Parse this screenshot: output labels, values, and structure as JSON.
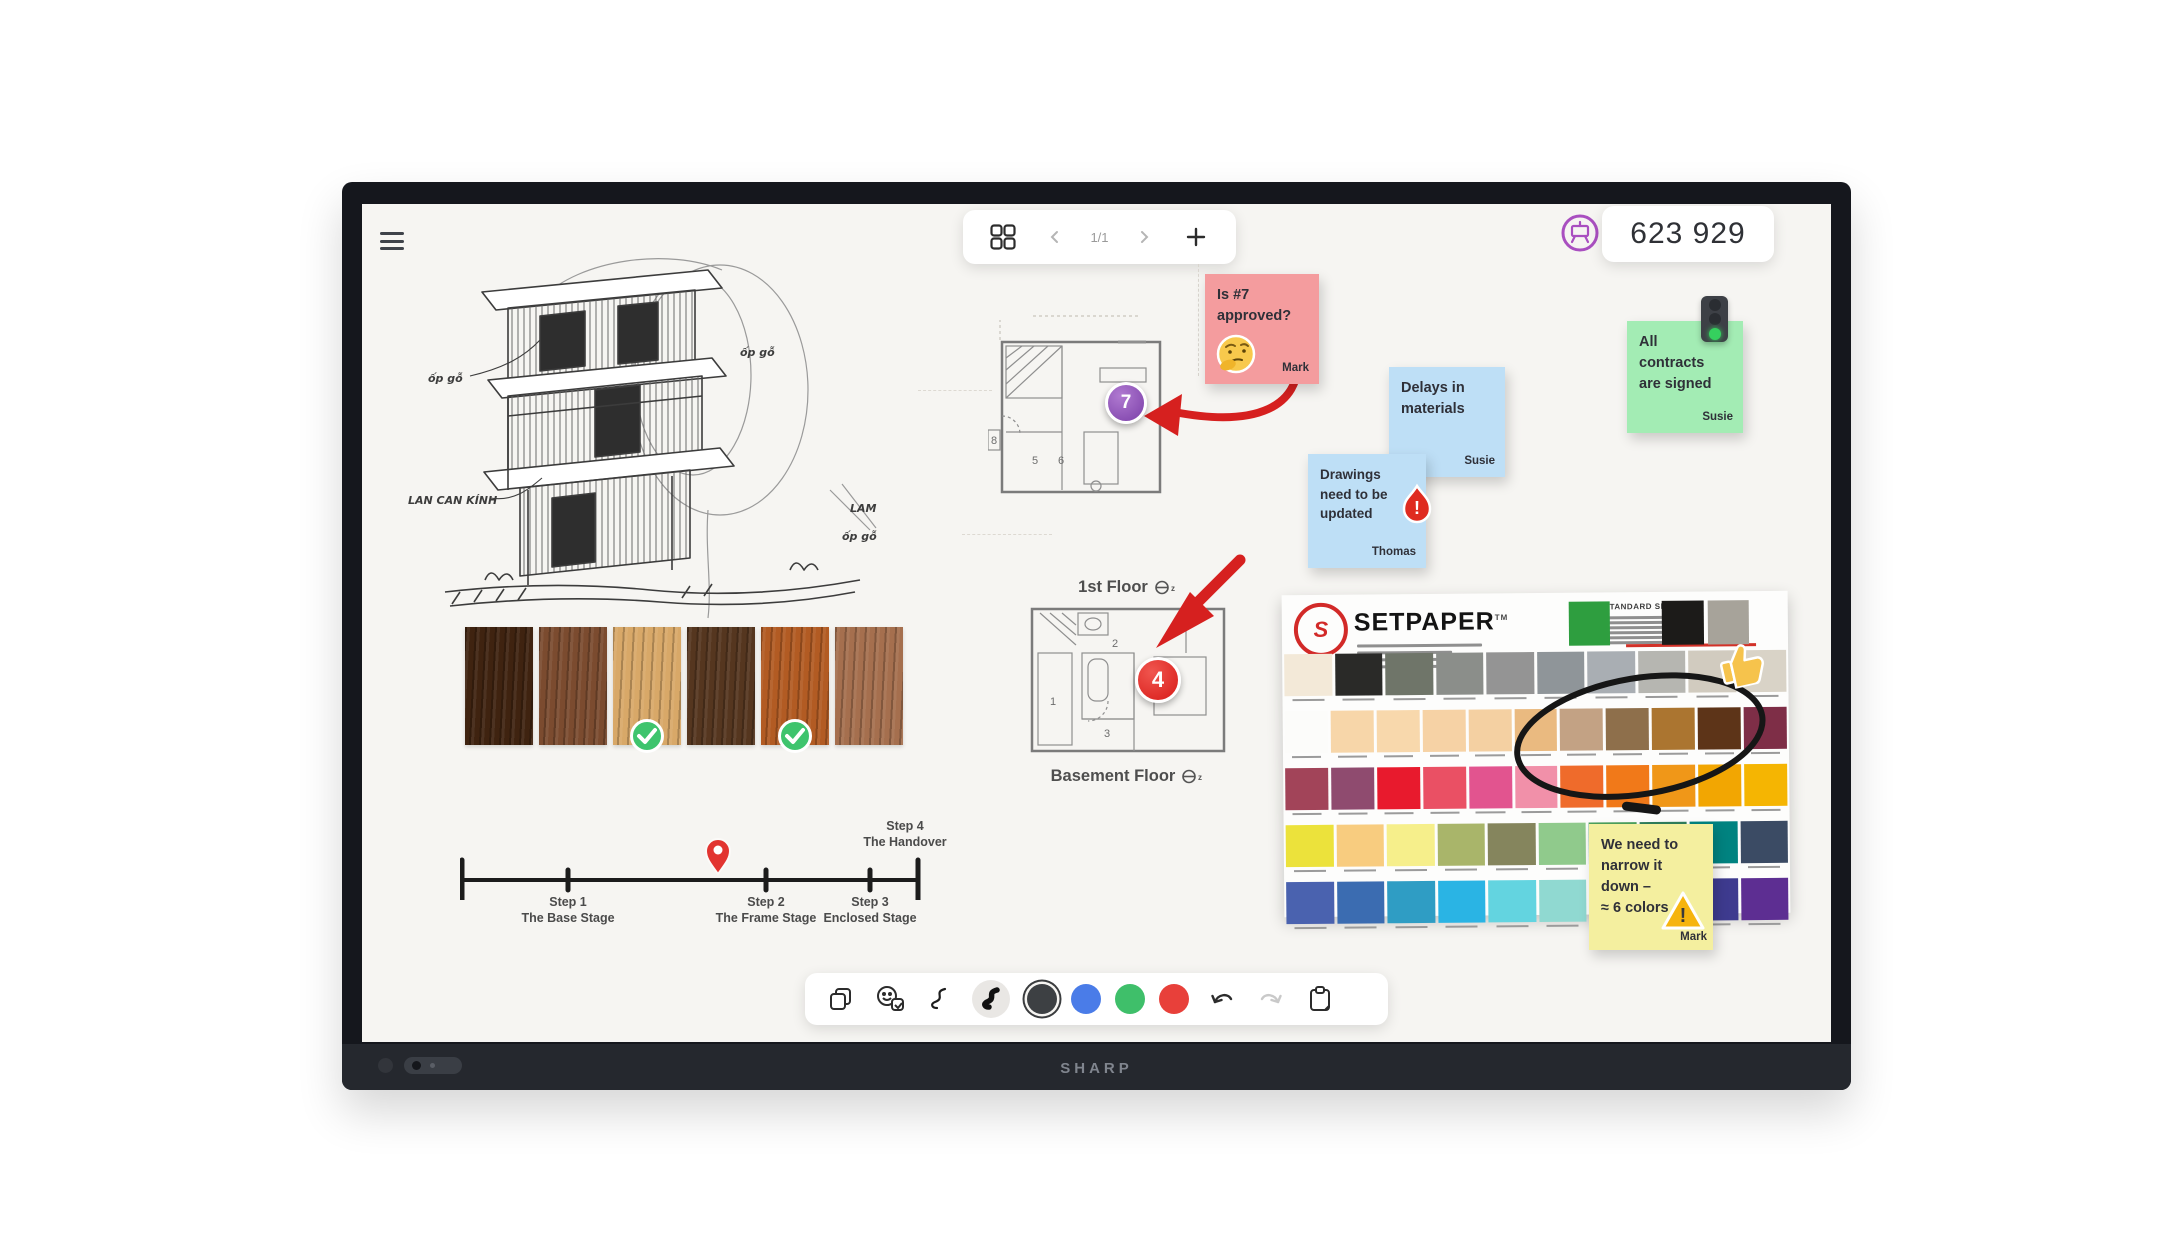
{
  "frame": {
    "brand": "SHARP"
  },
  "toolbar_top": {
    "page_indicator": "1/1"
  },
  "session": {
    "code": "623 929"
  },
  "toolbar_bottom": {
    "pen_colors": [
      "#3d4043",
      "#4a7ce8",
      "#3fbf6a",
      "#e8403a"
    ],
    "selected_color_index": 0
  },
  "canvas": {
    "sketch_labels": [
      "ốp gỗ",
      "ốp gỗ",
      "LAN CAN KÍNH",
      "LAM",
      "ốp gỗ"
    ],
    "plans": {
      "first_floor": {
        "label": "1st Floor",
        "room_numbers": [
          "5",
          "6",
          "8"
        ],
        "badge": "7"
      },
      "basement": {
        "label": "Basement Floor",
        "room_numbers": [
          "1",
          "2",
          "3"
        ],
        "badge": "4"
      }
    },
    "timeline": {
      "steps": [
        {
          "title": "Step 1",
          "subtitle": "The Base Stage"
        },
        {
          "title": "Step 2",
          "subtitle": "The Frame Stage"
        },
        {
          "title": "Step 3",
          "subtitle": "Enclosed Stage"
        },
        {
          "title": "Step 4",
          "subtitle": "The Handover"
        }
      ]
    },
    "wood_swatches": {
      "colors": [
        "#3f2310",
        "#7b4b2f",
        "#d8a868",
        "#55361f",
        "#b25b23",
        "#a56f4e"
      ],
      "approved_indexes": [
        2,
        4
      ]
    },
    "sticky_notes": {
      "pink": {
        "lines": [
          "Is #7",
          "approved?"
        ],
        "author": "Mark",
        "color": "#f49c9e"
      },
      "blue_delays": {
        "lines": [
          "Delays in",
          "materials"
        ],
        "author": "Susie",
        "color": "#bedff6"
      },
      "blue_drawings": {
        "lines": [
          "Drawings",
          "need to be",
          "updated"
        ],
        "author": "Thomas",
        "color": "#bedff6"
      },
      "green": {
        "lines": [
          "All",
          "contracts",
          "are signed"
        ],
        "author": "Susie",
        "color": "#a3ecb4"
      },
      "yellow": {
        "lines": [
          "We need to",
          "narrow it",
          "down –",
          "≈ 6 colors"
        ],
        "author": "Mark",
        "color": "#f4ef9f"
      }
    },
    "setpaper": {
      "title": "SETPAPER",
      "trademark": "TM",
      "sizes_heading": "STANDARD SIZES",
      "header_swatches": [
        "#2e9e3f",
        "#1c1b19",
        "#a7a39a"
      ],
      "rows": [
        [
          "#f3e9d8",
          "#2a2a28",
          "#6f7569",
          "#8b8e8a",
          "#949494",
          "#8f9599",
          "#a9aeb3",
          "#b6b6b1",
          "#d1cbbf",
          "#d9d3c7"
        ],
        [
          "#fcfcfa",
          "#f7d6a9",
          "#f8d8ac",
          "#f6d2a5",
          "#f4d0a2",
          "#eaba80",
          "#c3a284",
          "#8e6f4b",
          "#ab7530",
          "#5d3418",
          "#7e2e47"
        ],
        [
          "#a24459",
          "#8f4b6f",
          "#e81a2d",
          "#ea5064",
          "#e2548f",
          "#f190a9",
          "#ef6b2b",
          "#f17919",
          "#f09718",
          "#f2a602",
          "#f5b502"
        ],
        [
          "#ece23b",
          "#f8cc7f",
          "#f6ef8b",
          "#a9b56a",
          "#85855d",
          "#90ca8c",
          "#4ca15d",
          "#2f7e5c",
          "#008380",
          "#3b4b64"
        ],
        [
          "#4a62af",
          "#3b6cb1",
          "#2f9dc4",
          "#2ab4e4",
          "#63d4e0",
          "#90d9d1",
          "#70a9d0",
          "#aad1e4",
          "#3e3b8f",
          "#5d2e92"
        ]
      ]
    }
  }
}
